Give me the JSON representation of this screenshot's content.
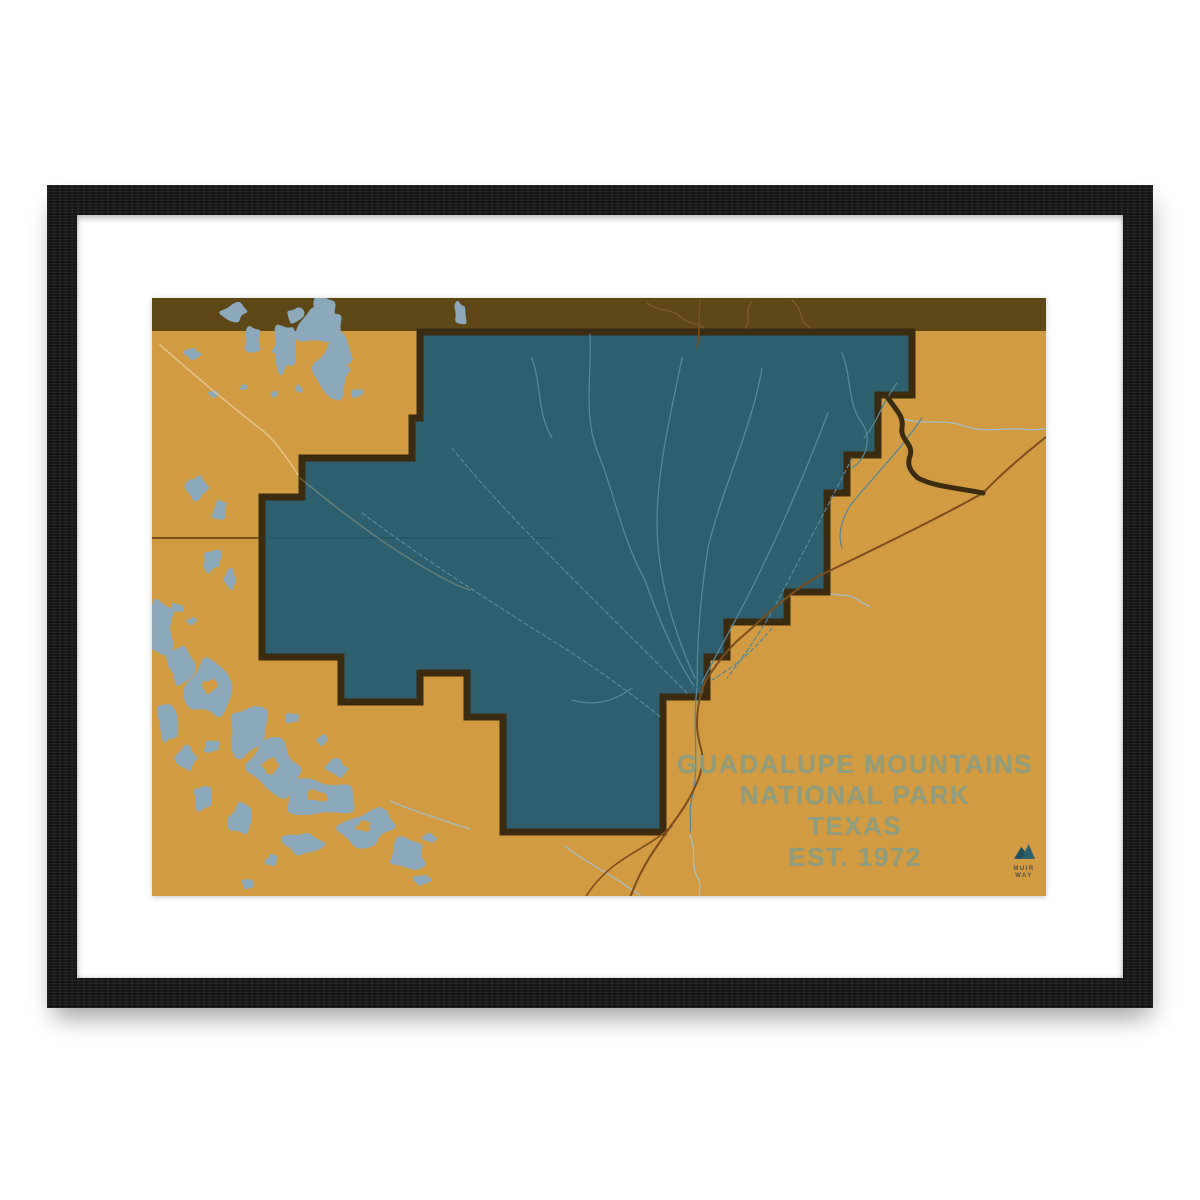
{
  "print": {
    "title_lines": [
      "GUADALUPE MOUNTAINS",
      "NATIONAL PARK",
      "TEXAS",
      "EST. 1972"
    ],
    "logo": {
      "line1": "MUIR",
      "line2": "WAY"
    }
  },
  "colors": {
    "frame": "#151515",
    "mat": "#ffffff",
    "ochre": "#d09b41",
    "park": "#2d5f6f",
    "stripe": "#5d4716",
    "border": "#3a2b11",
    "lake": "#8ba9ba",
    "stream": "#a3bfc7",
    "park_stream": "#57879a",
    "stripe_stream": "#7a5c28",
    "road": "#7b4e1d",
    "road_dark": "#3a2b11",
    "road_pale": "#e3c88e",
    "park_line": "#1f4a59",
    "title": "#8d9d84",
    "logo": "#2d5f6f",
    "logo_text": "#55534a"
  },
  "map": {
    "view": {
      "w": 894,
      "h": 598
    },
    "layers": [
      {
        "type": "rect",
        "name": "map-background",
        "fill": "ochre",
        "x": 0,
        "y": 0,
        "w": 894,
        "h": 598
      },
      {
        "type": "rect",
        "name": "top-stripe",
        "fill": "stripe",
        "x": 0,
        "y": 0,
        "w": 894,
        "h": 33
      },
      {
        "type": "paths",
        "name": "stripe-stream",
        "color": "stripe_stream",
        "width": 1.5,
        "opacity": 0.9,
        "items": [
          "M495,5 C510,15 520,10 530,20 C540,28 548,24 552,31",
          "M600,4 C590,14 602,22 592,31",
          "M640,2 C652,12 646,22 658,30"
        ]
      },
      {
        "type": "blobs",
        "name": "lake",
        "fill": "lake",
        "items": [
          [
            83,
            14,
            13,
            10,
            1
          ],
          [
            100,
            42,
            9,
            13,
            2
          ],
          [
            40,
            56,
            8,
            6,
            3
          ],
          [
            170,
            28,
            24,
            20,
            4
          ],
          [
            143,
            17,
            9,
            7,
            5
          ],
          [
            126,
            53,
            6,
            5,
            6
          ],
          [
            133,
            50,
            10,
            30,
            7
          ],
          [
            183,
            68,
            21,
            30,
            8
          ],
          [
            172,
            16,
            13,
            18,
            9
          ],
          [
            62,
            96,
            5,
            4,
            10
          ],
          [
            92,
            89,
            4,
            3,
            11
          ],
          [
            122,
            96,
            4,
            3,
            12
          ],
          [
            147,
            91,
            4,
            4,
            13
          ],
          [
            205,
            95,
            6,
            5,
            14
          ],
          [
            308,
            16,
            6,
            12,
            16
          ],
          [
            45,
            190,
            10,
            14,
            17
          ],
          [
            68,
            212,
            8,
            10,
            18
          ],
          [
            122,
            215,
            6,
            5,
            19
          ],
          [
            133,
            226,
            5,
            4,
            20
          ],
          [
            60,
            262,
            9,
            12,
            21
          ],
          [
            78,
            281,
            7,
            9,
            22
          ],
          [
            25,
            310,
            6,
            5,
            23
          ],
          [
            40,
            323,
            5,
            4,
            24
          ],
          [
            8,
            330,
            16,
            26,
            25
          ],
          [
            28,
            368,
            13,
            20,
            26
          ],
          [
            60,
            390,
            24,
            32,
            27
          ],
          [
            95,
            432,
            20,
            25,
            28
          ],
          [
            122,
            470,
            28,
            26,
            29
          ],
          [
            168,
            500,
            34,
            22,
            30
          ],
          [
            215,
            530,
            28,
            18,
            31
          ],
          [
            255,
            556,
            20,
            15,
            32
          ],
          [
            150,
            546,
            18,
            12,
            33
          ],
          [
            90,
            520,
            13,
            17,
            34
          ],
          [
            50,
            500,
            10,
            12,
            35
          ],
          [
            185,
            470,
            11,
            9,
            36
          ],
          [
            140,
            420,
            7,
            6,
            37
          ],
          [
            170,
            442,
            6,
            5,
            38
          ],
          [
            230,
            516,
            8,
            6,
            39
          ],
          [
            270,
            582,
            8,
            6,
            40
          ],
          [
            120,
            562,
            7,
            6,
            41
          ],
          [
            95,
            586,
            6,
            5,
            42
          ],
          [
            278,
            540,
            7,
            5,
            43
          ],
          [
            60,
            448,
            8,
            7,
            44
          ],
          [
            15,
            425,
            10,
            20,
            49
          ],
          [
            35,
            460,
            10,
            14,
            50
          ]
        ]
      },
      {
        "type": "blobs",
        "name": "lake-island",
        "fill": "ochre",
        "items": [
          [
            203,
            67,
            8,
            6,
            15
          ],
          [
            118,
            468,
            9,
            7,
            45
          ],
          [
            165,
            498,
            11,
            6,
            46
          ],
          [
            58,
            388,
            7,
            8,
            47
          ],
          [
            212,
            528,
            9,
            5,
            48
          ]
        ]
      },
      {
        "type": "paths",
        "name": "stream",
        "color": "stream",
        "width": 1.3,
        "items": [
          "M538,537 C545,552 538,568 546,580 C550,588 546,594 548,598",
          "M413,548 C430,562 448,570 462,580 C472,586 480,592 488,597",
          "M238,503 C258,512 280,518 296,524 C305,527 312,529 318,531",
          "M748,120 C770,128 792,120 812,128 C835,136 858,128 876,132 L894,131",
          "M668,292 C682,300 696,294 706,302 C712,306 715,307 718,309"
        ]
      },
      {
        "type": "paths",
        "name": "road-pale",
        "color": "road_pale",
        "width": 1.6,
        "opacity": 0.9,
        "items": [
          "M8,47 C40,75 76,106 110,132 C124,143 138,164 148,180"
        ]
      },
      {
        "type": "paths",
        "name": "state-line",
        "color": "road",
        "width": 2,
        "items": [
          "M0,240 L112,240"
        ]
      },
      {
        "type": "polygon",
        "name": "park-boundary",
        "fill": "park",
        "stroke": "border",
        "width": 7,
        "points": "268,34 760,34 760,97 726,97 726,157 695,157 695,195 675,195 675,294 635,294 635,324 575,324 575,359 555,359 555,399 511,399 511,534 351,534 351,419 315,419 315,375 268,375 268,404 189,404 189,359 110,359 110,199 150,199 150,160 260,160 260,120 268,120"
      },
      {
        "type": "paths",
        "name": "state-line-park",
        "color": "park_line",
        "width": 1.8,
        "opacity": 0.55,
        "items": [
          "M112,240 L400,240"
        ]
      },
      {
        "type": "paths",
        "name": "road-pale-park",
        "color": "road_pale",
        "width": 1.5,
        "opacity": 0.3,
        "items": [
          "M148,180 C190,215 235,248 268,267 C290,280 305,288 318,292"
        ]
      },
      {
        "type": "paths",
        "name": "park-stream",
        "color": "park_stream",
        "width": 1.3,
        "items": [
          "M438,36 C440,80 430,120 448,160 C462,195 470,240 492,280 C505,315 520,355 542,388",
          "M530,60 C520,110 505,170 505,225 C505,275 520,330 543,380",
          "M610,70 C600,130 570,190 556,250 C548,300 545,345 545,388",
          "M676,115 C655,170 630,230 600,290 C580,330 562,360 550,385",
          "M545,390 C540,430 548,470 540,500 C536,515 540,525 538,534",
          "M690,55 C700,80 695,105 710,125 C720,140 715,160 700,170",
          "M745,85 C730,105 725,125 712,140",
          "M770,120 C750,150 725,175 700,205 C690,220 685,235 690,250",
          "M480,390 C460,405 440,408 420,402",
          "M380,60 C390,90 385,115 400,140"
        ]
      },
      {
        "type": "paths",
        "name": "park-stream-dashed",
        "color": "park_stream",
        "width": 1.2,
        "dash": "4 3",
        "items": [
          "M700,160 C675,210 648,260 622,310 C605,340 590,360 575,380",
          "M300,150 C340,200 390,250 450,310 C480,340 510,370 535,395",
          "M210,215 C270,260 340,305 420,355 C455,378 485,400 510,420",
          "M620,330 C600,355 580,370 560,382"
        ]
      },
      {
        "type": "paths",
        "name": "road-main",
        "color": "road",
        "width": 2,
        "items": [
          "M894,139 C870,158 850,175 831,195 C790,218 745,240 675,274 C640,290 610,322 585,343 C570,358 562,370 554,382 C548,395 545,410 545,426 C545,445 552,452 550,464 C549,478 545,485 540,495 C532,512 520,525 512,538 C500,555 488,572 478,600"
        ]
      },
      {
        "type": "paths",
        "name": "road-branch",
        "color": "road",
        "width": 1.6,
        "items": [
          "M520,528 C505,542 488,550 470,562 C455,572 442,585 433,600",
          "M548,2 C546,15 549,30 545,49"
        ]
      },
      {
        "type": "paths",
        "name": "highway",
        "color": "road_dark",
        "width": 5,
        "items": [
          "M736,100 C744,112 752,118 750,130 C748,142 762,146 758,158 C754,168 760,175 766,180 C780,188 805,190 831,195"
        ]
      }
    ]
  }
}
